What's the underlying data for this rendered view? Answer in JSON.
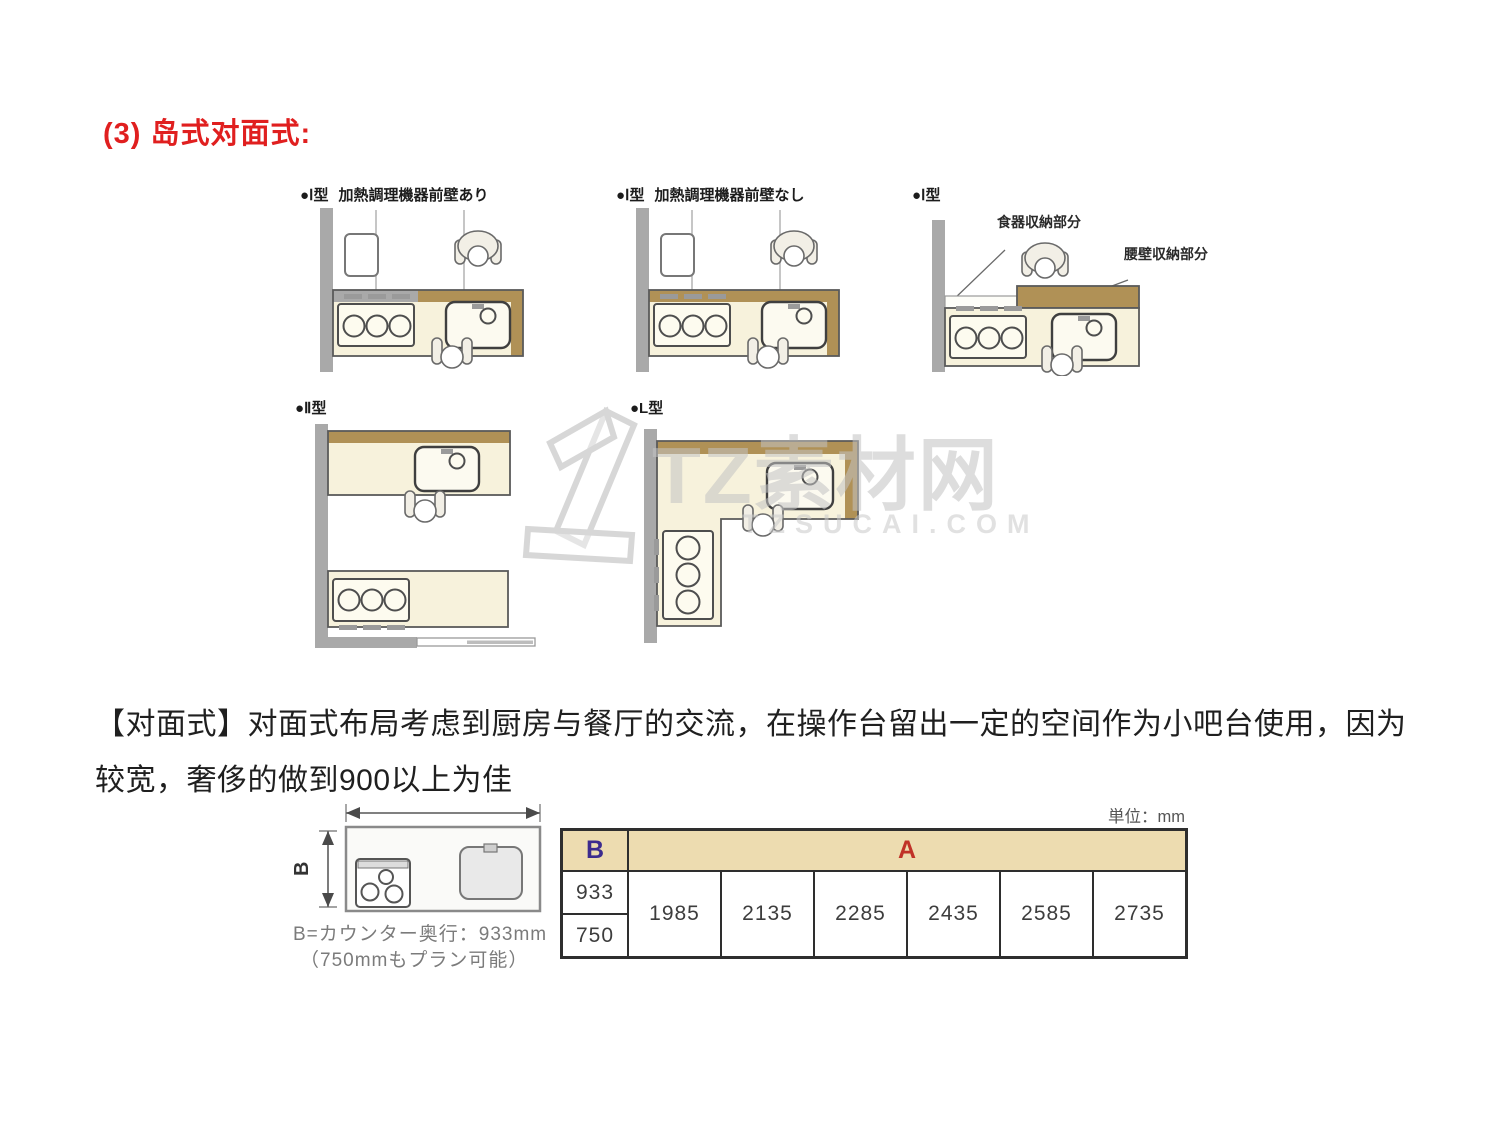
{
  "heading": "(3) 岛式对面式:",
  "diagrams": [
    {
      "type_label": "●Ⅰ型",
      "subtitle": "加熱調理機器前壁あり"
    },
    {
      "type_label": "●Ⅰ型",
      "subtitle": "加熱調理機器前壁なし"
    },
    {
      "type_label": "●Ⅰ型",
      "subtitle": "",
      "annotations": [
        "食器収納部分",
        "腰壁収納部分"
      ]
    },
    {
      "type_label": "●Ⅱ型",
      "subtitle": ""
    },
    {
      "type_label": "●L型",
      "subtitle": ""
    }
  ],
  "watermark": {
    "title": "TZ素材网",
    "domain": "TZSUCAI.COM"
  },
  "paragraph": {
    "line1": "【对面式】对面式布局考虑到厨房与餐厅的交流，在操作台留出一定的空间作为小吧台使用，因为",
    "line2": "较宽，奢侈的做到900以上为佳"
  },
  "counter_diagram": {
    "b_label": "B",
    "caption_line1": "B=カウンター奥行：933mm",
    "caption_line2": "（750mmもプラン可能）"
  },
  "size_table": {
    "unit_label": "単位：mm",
    "col_b_header": "B",
    "col_a_header": "A",
    "b_values": [
      "933",
      "750"
    ],
    "a_values": [
      "1985",
      "2135",
      "2285",
      "2435",
      "2585",
      "2735"
    ]
  },
  "colors": {
    "heading_red": "#e01f1f",
    "table_header_tan": "#eddcb0",
    "table_a_red": "#c03228",
    "table_b_purple": "#3c2b8e",
    "counter_cream": "#f7f2dc",
    "counter_brown": "#b09156",
    "wall_gray": "#a9a9a9"
  }
}
